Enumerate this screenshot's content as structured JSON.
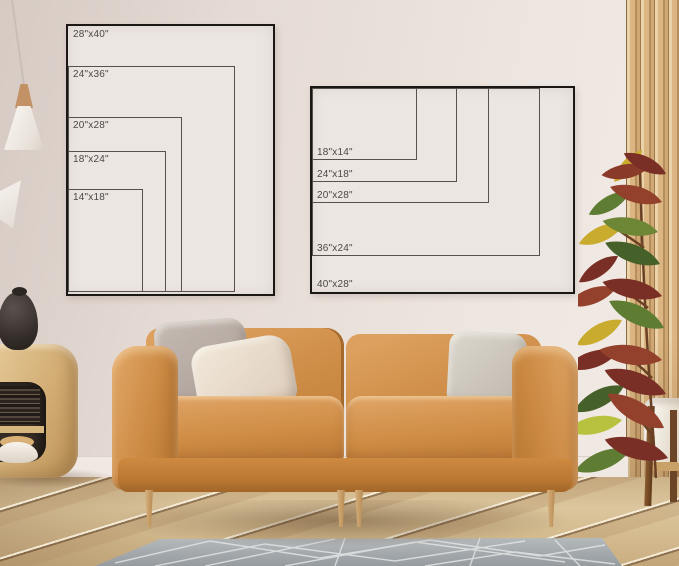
{
  "posters": {
    "portrait": {
      "name": "portrait poster size chart",
      "sizes": [
        {
          "label": "28\"x40\""
        },
        {
          "label": "24\"x36\""
        },
        {
          "label": "20\"x28\""
        },
        {
          "label": "18\"x24\""
        },
        {
          "label": "14\"x18\""
        }
      ]
    },
    "landscape": {
      "name": "landscape poster size chart",
      "sizes": [
        {
          "label": "40\"x28\""
        },
        {
          "label": "36\"x24\""
        },
        {
          "label": "20\"x28\""
        },
        {
          "label": "24\"x18\""
        },
        {
          "label": "18\"x14\""
        }
      ]
    }
  },
  "colors": {
    "wall": "#e8ded8",
    "frame_line": "#1a1714",
    "inner_line": "#57514c",
    "label_text": "#4b4744",
    "sofa_leather": "#cd8c46",
    "rug_gray": "#a3a8ab",
    "floor_wood": "#d3b98d",
    "slat_panel_wood": "#d3ad78",
    "plant_pot": "#f2ede6"
  }
}
